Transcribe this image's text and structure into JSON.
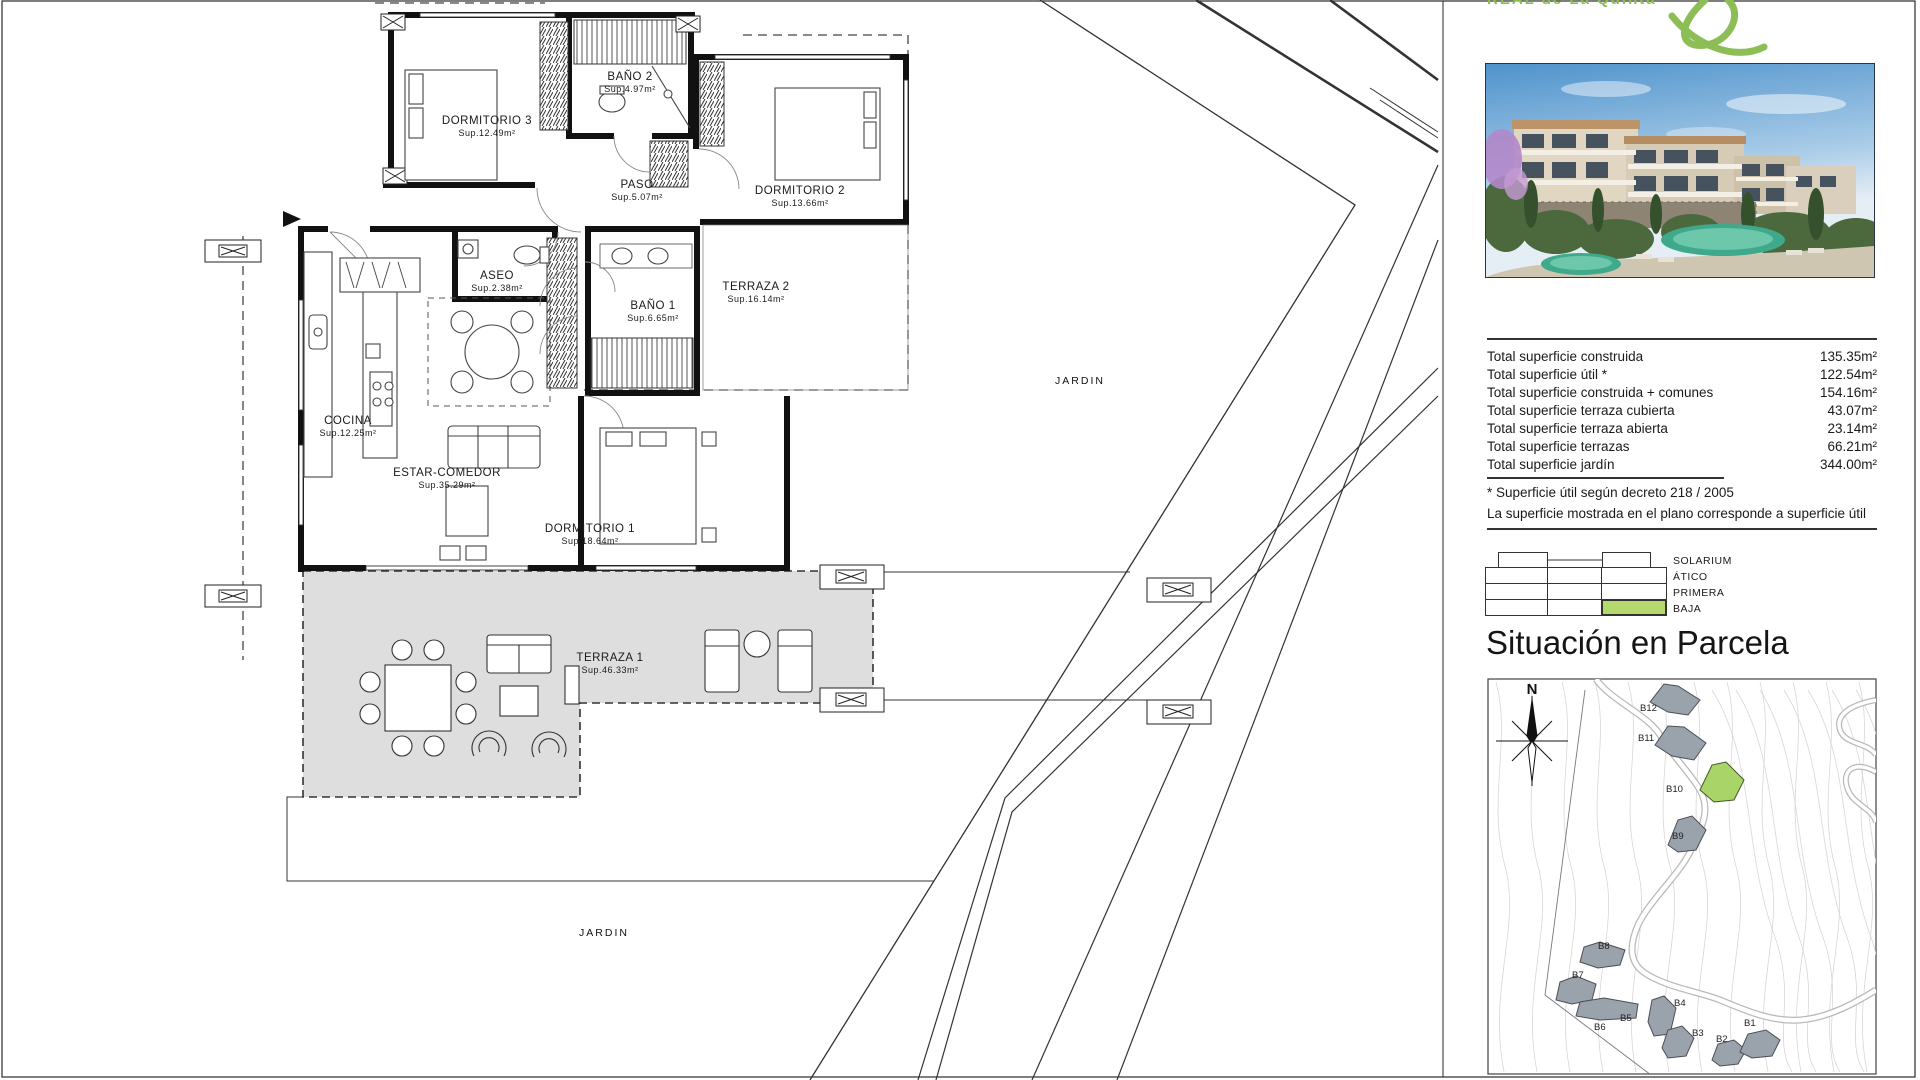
{
  "logo": {
    "brand": "REAL de La Quinta"
  },
  "floor_plan": {
    "garden_label": "JARDIN",
    "rooms": [
      {
        "name": "DORMITORIO 3",
        "area": "Sup.12.49m²"
      },
      {
        "name": "BAÑO 2",
        "area": "Sup.4.97m²"
      },
      {
        "name": "PASO",
        "area": "Sup.5.07m²"
      },
      {
        "name": "DORMITORIO 2",
        "area": "Sup.13.66m²"
      },
      {
        "name": "ASEO",
        "area": "Sup.2.38m²"
      },
      {
        "name": "BAÑO 1",
        "area": "Sup.6.65m²"
      },
      {
        "name": "TERRAZA 2",
        "area": "Sup.16.14m²"
      },
      {
        "name": "COCINA",
        "area": "Sup.12.25m²"
      },
      {
        "name": "ESTAR-COMEDOR",
        "area": "Sup.35.29m²"
      },
      {
        "name": "DORMITORIO 1",
        "area": "Sup.18.64m²"
      },
      {
        "name": "TERRAZA 1",
        "area": "Sup.46.33m²"
      }
    ]
  },
  "summary": {
    "rows": [
      {
        "label": "Total superficie construida",
        "value": "135.35m²"
      },
      {
        "label": "Total superficie útil *",
        "value": "122.54m²"
      },
      {
        "label": "Total superficie construida + comunes",
        "value": "154.16m²"
      },
      {
        "label": "Total superficie terraza cubierta",
        "value": "43.07m²"
      },
      {
        "label": "Total superficie terraza abierta",
        "value": "23.14m²"
      },
      {
        "label": "Total superficie terrazas",
        "value": "66.21m²"
      },
      {
        "label": "Total superficie jardín",
        "value": "344.00m²"
      }
    ],
    "footnote1": "* Superficie útil según decreto 218 / 2005",
    "footnote2": "La superficie mostrada en el plano corresponde a superficie útil"
  },
  "legend": {
    "levels": [
      "SOLARIUM",
      "ÁTICO",
      "PRIMERA",
      "BAJA"
    ],
    "highlighted": "BAJA",
    "highlight_color": "#b5d96d"
  },
  "site_plan": {
    "title": "Situación en Parcela",
    "north_label": "N",
    "highlighted": "B10",
    "buildings": [
      "B12",
      "B11",
      "B10",
      "B9",
      "B8",
      "B7",
      "B6",
      "B5",
      "B4",
      "B3",
      "B2",
      "B1"
    ]
  }
}
